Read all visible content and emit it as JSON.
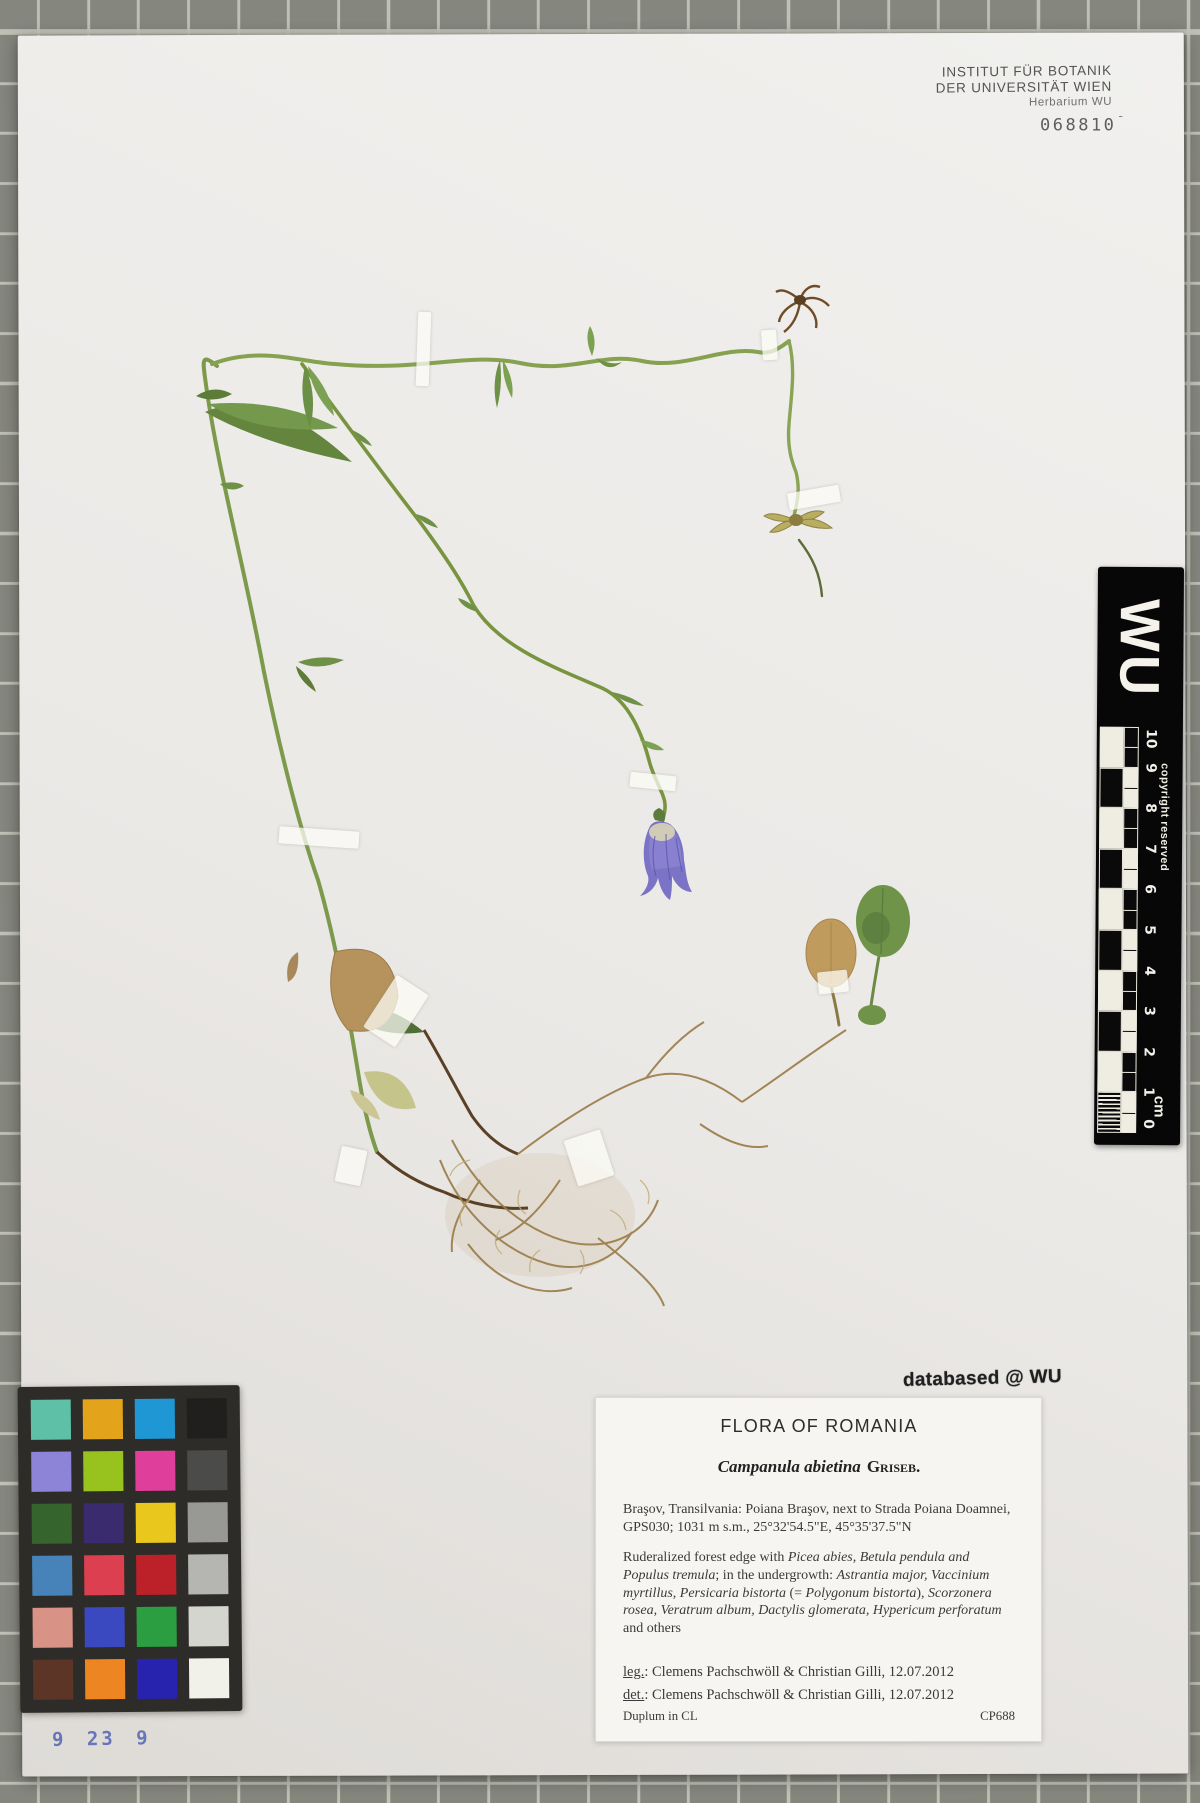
{
  "institution_stamp": {
    "line1": "INSTITUT FÜR BOTANIK",
    "line2": "DER UNIVERSITÄT WIEN",
    "line3": "Herbarium WU",
    "accession_number": "068810",
    "accession_suffix": "¯"
  },
  "ruler": {
    "letters": "WU",
    "copyright": "copyright reserved",
    "unit": "cm",
    "ticks": [
      "0",
      "1",
      "2",
      "3",
      "4",
      "5",
      "6",
      "7",
      "8",
      "9",
      "10"
    ]
  },
  "stamps": {
    "databased": "databased @ WU"
  },
  "label": {
    "title": "FLORA OF ROMANIA",
    "species": "Campanula abietina",
    "authority": "Griseb.",
    "locality": "Braşov, Transilvania: Poiana Braşov, next to Strada Poiana Doamnei, GPS030; 1031 m s.m., 25°32'54.5\"E, 45°35'37.5\"N",
    "habitat_runs": [
      {
        "t": "Ruderalized forest edge with ",
        "i": false
      },
      {
        "t": "Picea abies, Betula pendula and Populus tremula",
        "i": true
      },
      {
        "t": "; in the undergrowth: ",
        "i": false
      },
      {
        "t": "Astrantia major, Vaccinium myrtillus, Persicaria bistorta",
        "i": true
      },
      {
        "t": " (= ",
        "i": false
      },
      {
        "t": "Polygonum bistorta",
        "i": true
      },
      {
        "t": "), ",
        "i": false
      },
      {
        "t": "Scorzonera rosea, Veratrum album, Dactylis glomerata, Hypericum perforatum",
        "i": true
      },
      {
        "t": " and others",
        "i": false
      }
    ],
    "leg_label": "leg.",
    "leg_text": ": Clemens Pachschwöll & Christian Gilli, 12.07.2012",
    "det_label": "det.",
    "det_text": ": Clemens Pachschwöll & Christian Gilli, 12.07.2012",
    "duplum": "Duplum in CL",
    "collection_code": "CP688"
  },
  "color_checker": {
    "rows": [
      [
        "#5fc0a8",
        "#e3a41c",
        "#1f97d4",
        "#201f1d"
      ],
      [
        "#8d84d8",
        "#98c21d",
        "#df3f9a",
        "#4b4b49"
      ],
      [
        "#35652d",
        "#3a2a6e",
        "#e9c71d",
        "#989895"
      ],
      [
        "#4783b9",
        "#dc4050",
        "#bc2029",
        "#b5b5b2"
      ],
      [
        "#d89386",
        "#3b49c1",
        "#2b9e41",
        "#d5d5d0"
      ],
      [
        "#5c3526",
        "#ec8522",
        "#2823af",
        "#f1f1e9"
      ]
    ]
  },
  "handwritten_number": "9 23 9",
  "colors": {
    "background_tile": "#85867e",
    "tile_grout": "#c6c7bc",
    "sheet": "#edebe8",
    "ruler_black": "#070707",
    "stamp_ink": "#535353",
    "databased_ink": "#202020",
    "handwriting_ink": "#5767b5",
    "flower_violet": "#7b74c6",
    "stem_green": "#7d9a4c"
  }
}
